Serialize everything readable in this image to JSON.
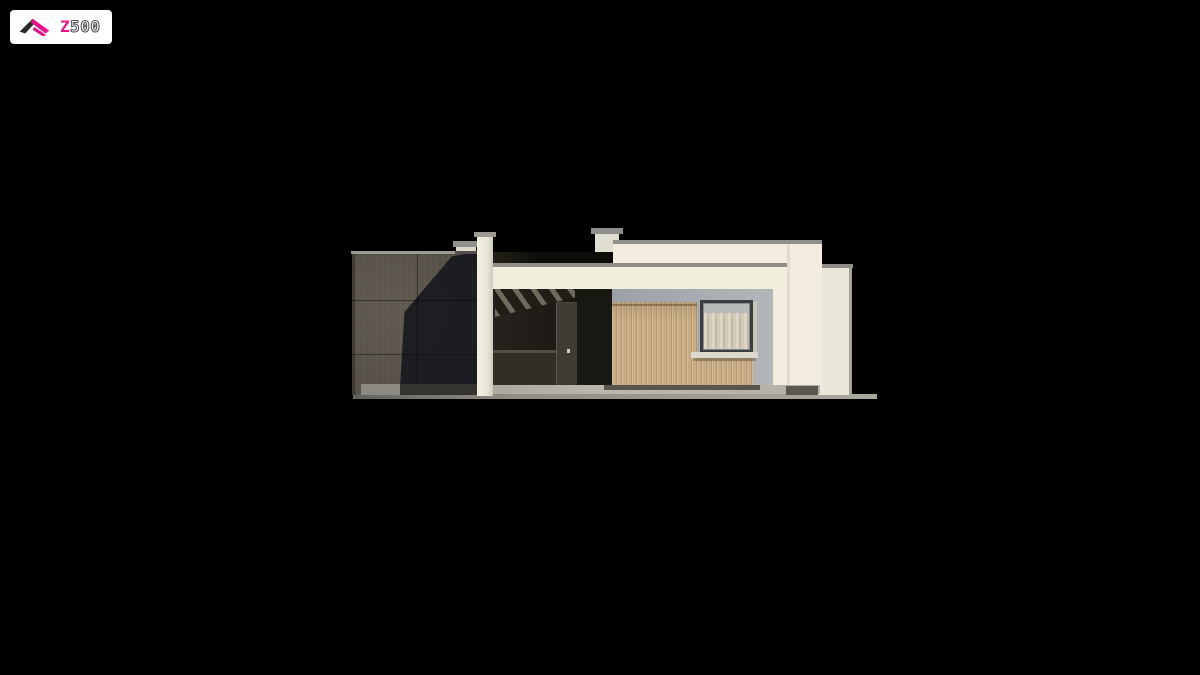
{
  "logo": {
    "brand_full": "Z500",
    "brand_accent": "Z",
    "brand_rest": "500"
  },
  "palette": {
    "background": "#000000",
    "logo_pink": "#ec0f8c",
    "logo_outline_gray": "#56575b",
    "logo_icon_black": "#2a2a2a",
    "wall_cream": "#f2edde",
    "parapet_cap_gray": "#90908a",
    "cladding_dark_panel": "#575147",
    "cladding_shadow": "#23242a",
    "porch_interior_dark": "#201d17",
    "wood_cladding": "#c9ac83",
    "recess_gray": "#9aa0a5",
    "window_frame": "#3a3e41",
    "window_glass": "#b7bbbc",
    "curtain_light": "#ddd5c5",
    "sill_white": "#dcd9ce",
    "ground_gray": "#8f8d85"
  },
  "elevation": {
    "view": "side elevation",
    "sections": [
      "dark-panel garage block",
      "white pillar",
      "covered porch",
      "wood-clad recess with window",
      "stepped white parapet",
      "side return wall"
    ]
  }
}
